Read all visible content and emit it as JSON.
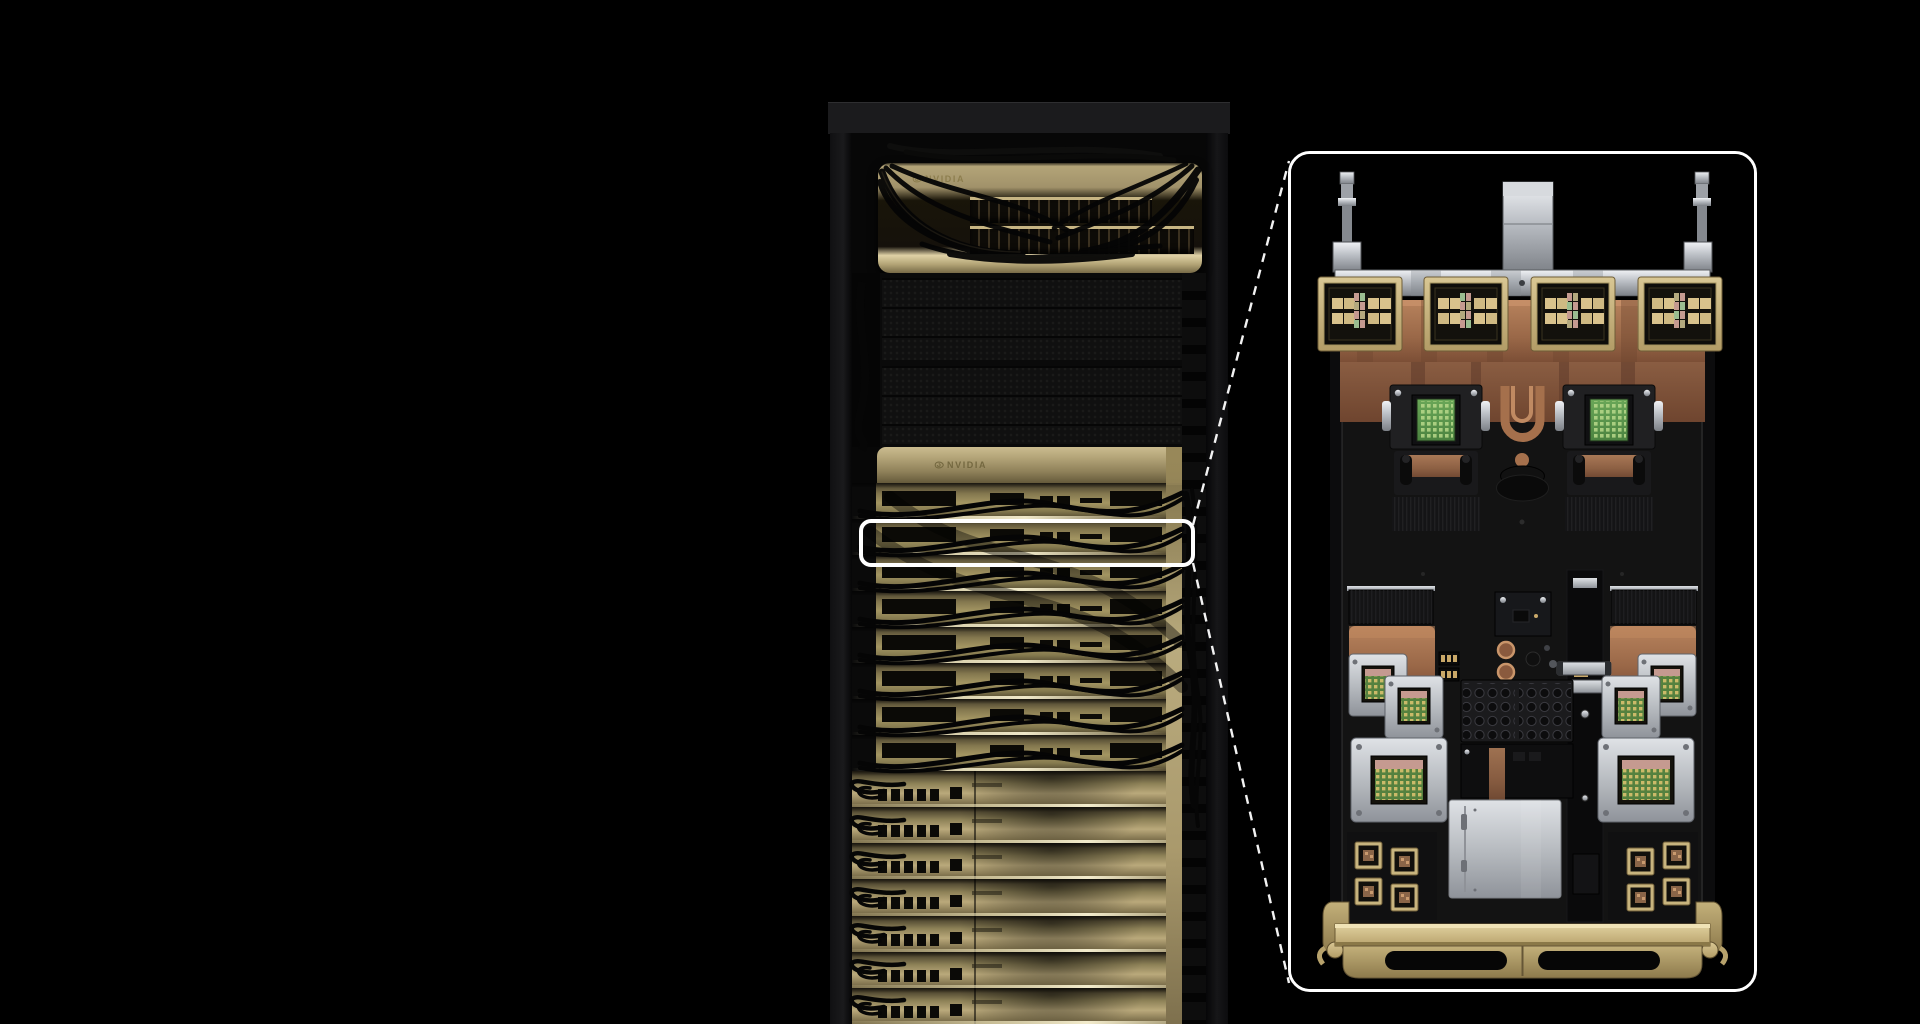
{
  "scene": {
    "background_color": "#000000",
    "subject": "server-rack-with-tray-callout"
  },
  "colors": {
    "bg": "#000000",
    "white": "#ffffff",
    "logo-gold": "#8d7e4e",
    "champagne": "#b3a478",
    "champagne-bright": "#ece2bf",
    "gold-row": "#a39562",
    "gold-frame": "#c8b47e",
    "copper": "#9c6c50",
    "silver": "#c6c9ce",
    "pcb-green": "#5f9b4e",
    "die-tan": "#d9c28c",
    "cable": "#050505",
    "rack-frame": "#1b1b1d"
  },
  "rack": {
    "top_switch_unit": {
      "brand_label": "NVIDIA",
      "port_rows": 2
    },
    "blanking_panels": 2,
    "compute_section": {
      "brand_label": "NVIDIA",
      "cabled_switch_rows": 8,
      "compute_tray_rows": 7
    }
  },
  "callout": {
    "highlighted_row_index": 2,
    "tray_detail": {
      "coolant_fittings": 2,
      "gpu_packages": 4,
      "cold_plates_with_green_die": 2,
      "nic_modules_per_side": 3,
      "gold_chiplets_per_side": 4,
      "capacitor_banks": 2,
      "handle_cutouts": 2
    }
  }
}
